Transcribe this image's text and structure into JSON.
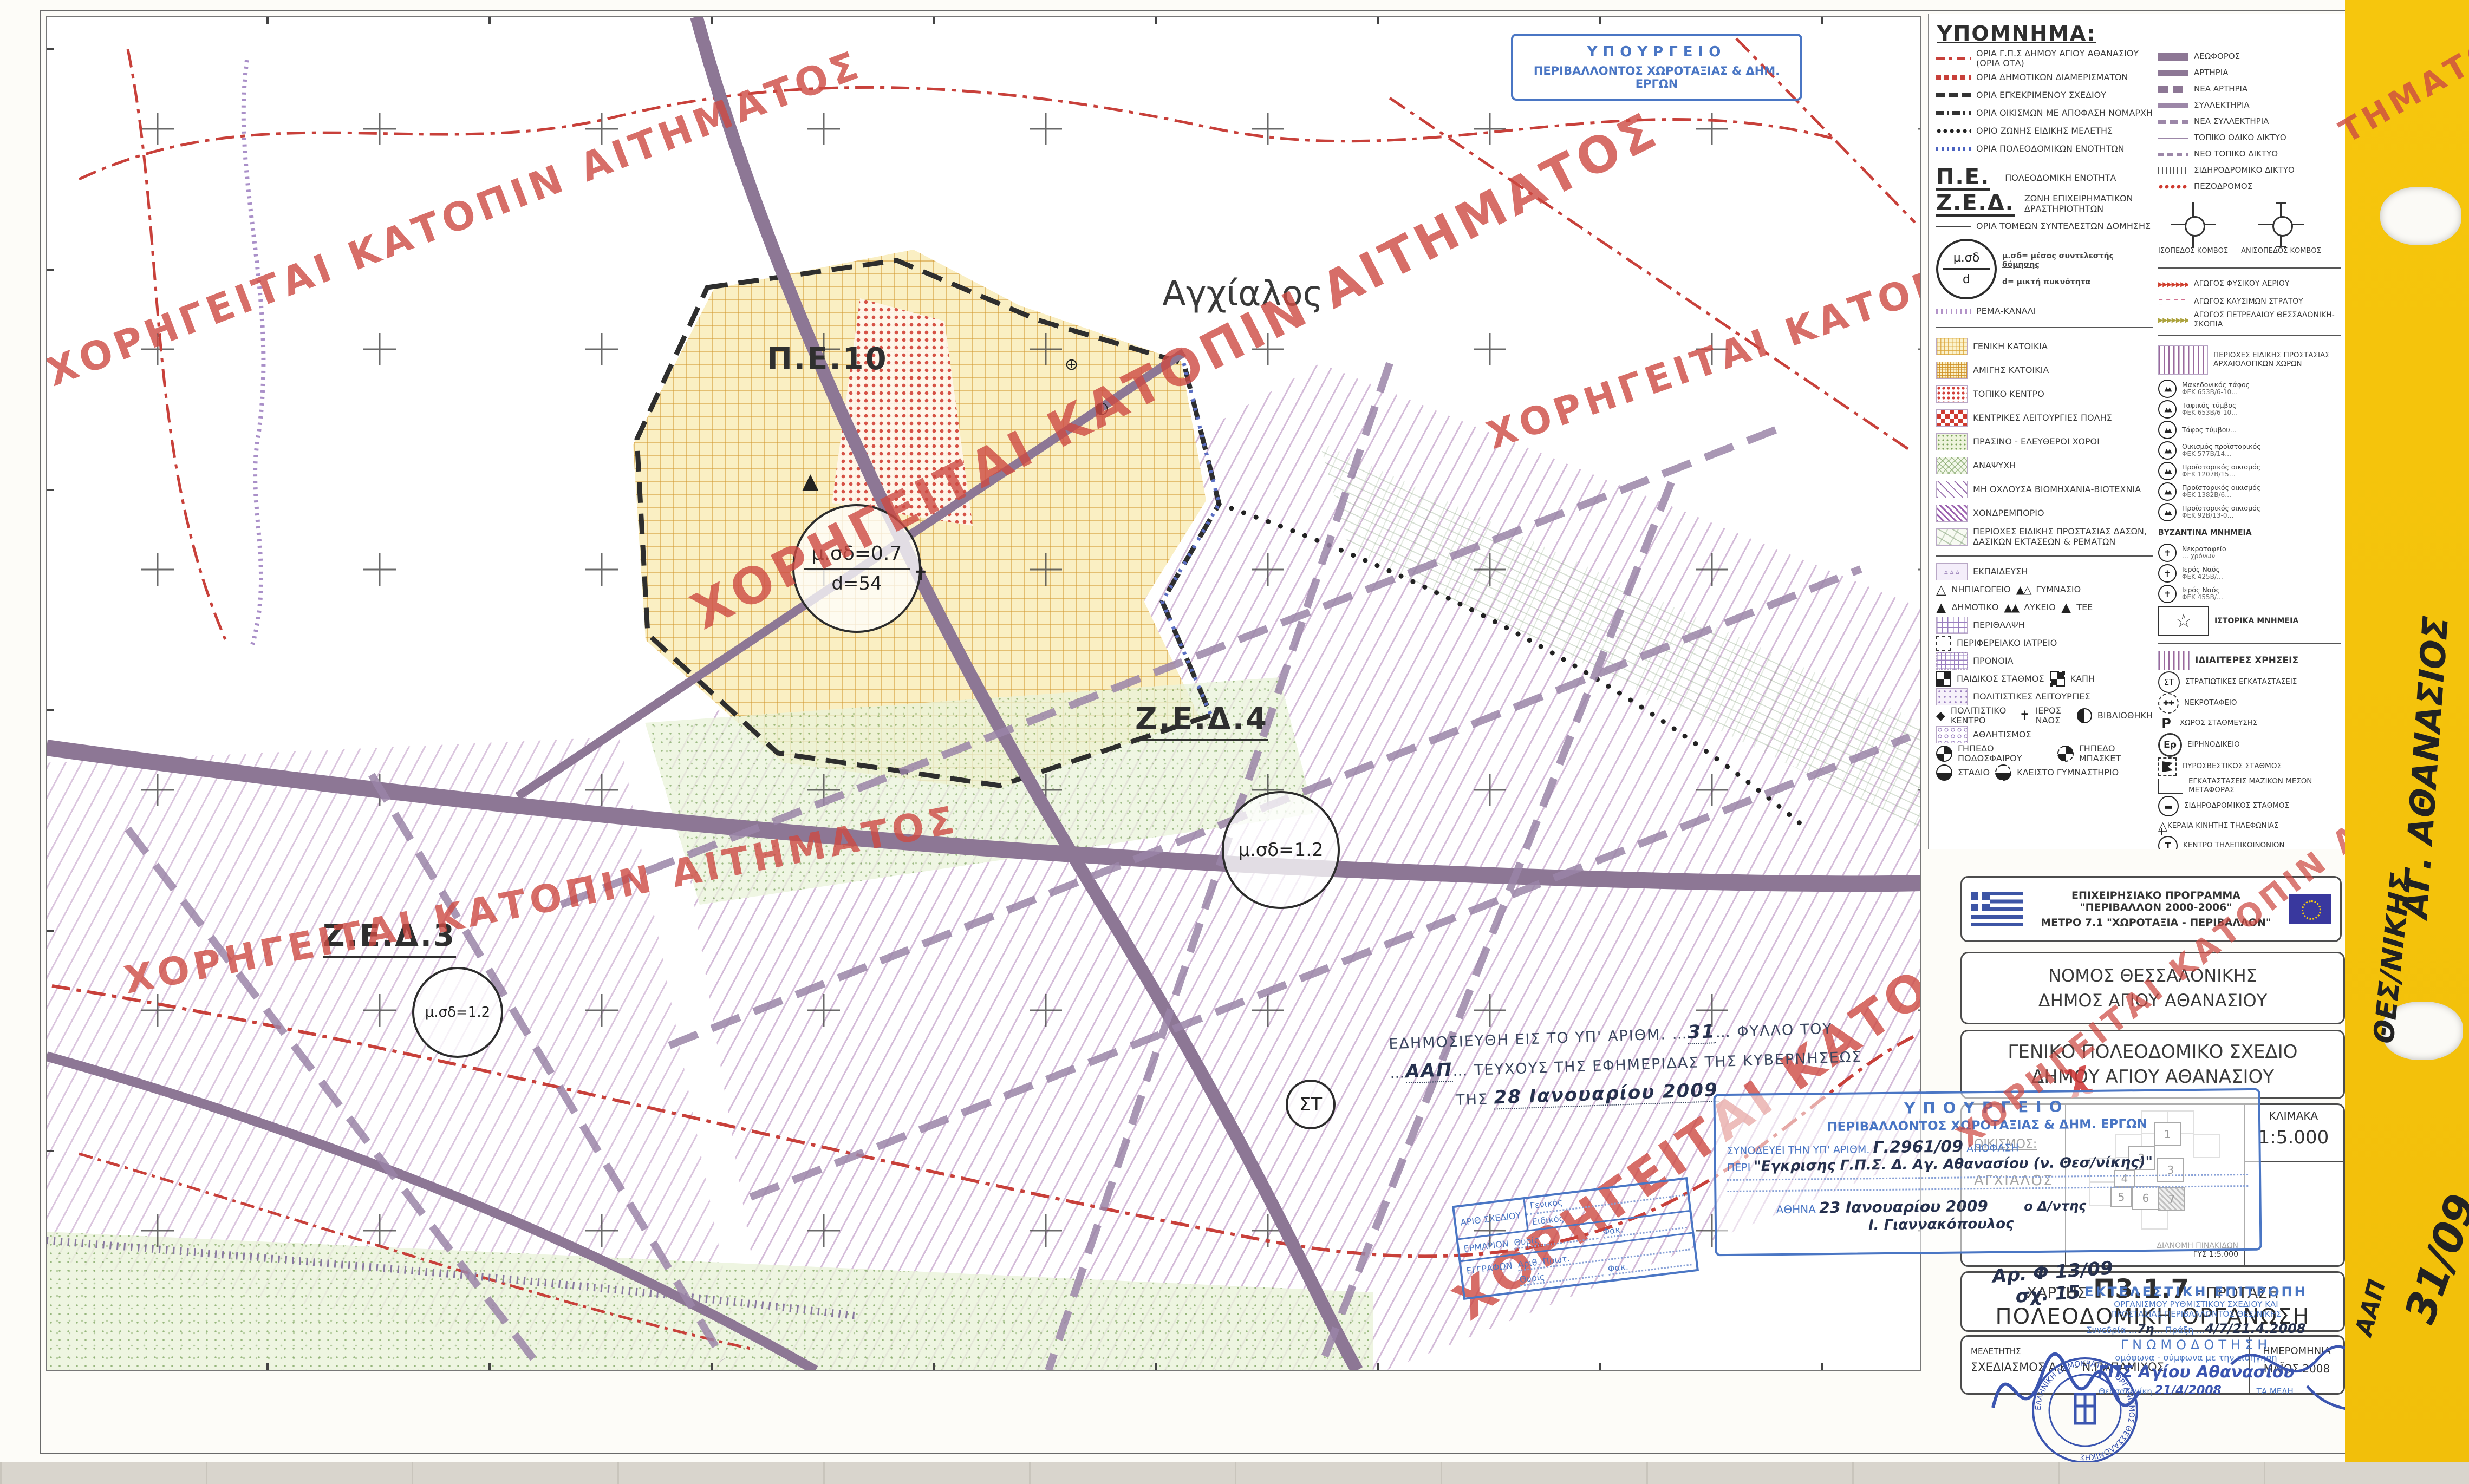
{
  "watermark_text": "ΧΟΡΗΓΕΙΤΑΙ ΚΑΤΟΠΙΝ ΑΙΤΗΜΑΤΟΣ",
  "watermark_frag1": "ΤΗΜΑΤΟΣ",
  "watermark_frag2": "ΙΤΗΜΑΤΟΣ",
  "map": {
    "town_label": "Αγχίαλος",
    "pe_label": "Π.Ε.10",
    "zed4_label": "Ζ.Ε.Δ.4",
    "zed3_label": "Ζ.Ε.Δ.3",
    "st_label": "ΣΤ",
    "circle_pe10_l1": "μ.σδ=0.7",
    "circle_pe10_l2": "d=54",
    "circle_zed4": "μ.σδ=1.2",
    "circle_zed3": "μ.σδ=1.2",
    "left_axis": [
      {
        "v": "4508500"
      },
      {
        "v": "4508000"
      },
      {
        "v": "4507500"
      },
      {
        "v": "4507000"
      },
      {
        "v": "4506500"
      },
      {
        "v": "4506000"
      },
      {
        "v": "4505500"
      }
    ],
    "bottom_axis": [
      {
        "v": "395000"
      },
      {
        "v": "395500"
      },
      {
        "v": "396000"
      },
      {
        "v": "396500"
      },
      {
        "v": "397000"
      },
      {
        "v": "397500"
      },
      {
        "v": "398000"
      },
      {
        "v": "398500"
      },
      {
        "v": "399000"
      }
    ],
    "spot_heights": [
      {
        "v": "8,90"
      },
      {
        "v": "9,00"
      },
      {
        "v": "9,30"
      },
      {
        "v": "10,00"
      },
      {
        "v": "10,20"
      }
    ]
  },
  "side_tab": {
    "line1": "ΑΓ. ΑΘΑΝΑΣΙΟΣ",
    "line2": "ΘΕΣ/ΝΙΚΗΣ",
    "line3": "31/09",
    "line4": "ΑΑΠ"
  },
  "stamps": {
    "ministry_top1": "ΥΠΟΥΡΓΕΙΟ",
    "ministry_top2": "ΠΕΡΙΒΑΛΛΟΝΤΟΣ ΧΩΡΟΤΑΞΙΑΣ & ΔΗΜ. ΕΡΓΩΝ",
    "gazette_pre": "ΕΔΗΜΟΣΙΕΥΘΗ ΕΙΣ ΤΟ ΥΠ' ΑΡΙΘΜ.",
    "gazette_no": "31",
    "gazette_mid": "ΦΥΛΛΟ ΤΟΥ",
    "gazette_issue": "ΑΑΠ",
    "gazette_post": "ΤΕΥΧΟΥΣ ΤΗΣ ΕΦΗΜΕΡΙΔΑΣ ΤΗΣ ΚΥΒΕΡΝΗΣΕΩΣ",
    "gazette_tis": "ΤΗΣ",
    "gazette_date": "28 Ιανουαρίου 2009",
    "decision_h1": "ΥΠΟΥΡΓΕΙΟ",
    "decision_h2": "ΠΕΡΙΒΑΛΛΟΝΤΟΣ ΧΩΡΟΤΑΞΙΑΣ & ΔΗΜ. ΕΡΓΩΝ",
    "decision_pre": "ΣΥΝΟΔΕΥΕΙ ΤΗΝ ΥΠ' ΑΡΙΘΜ.",
    "decision_no": "Γ.2961/09",
    "decision_apofasi": "ΑΠΟΦΑΣΗ",
    "decision_peri": "ΠΕΡΙ",
    "decision_subject": "\"Εγκρισης Γ.Π.Σ. Δ. Αγ. Αθανασίου (ν. Θεσ/νίκης)\"",
    "decision_city": "ΑΘΗΝΑ",
    "decision_date": "23 Ιανουαρίου 2009",
    "decision_role": "ο Δ/ντης",
    "decision_sign": "Ι. Γιαννακόπουλος",
    "file_note1": "Αρ. Φ 13/09",
    "file_note2": "σχ. 15",
    "filing_r1": "ΑΡΙΘ ΣΧΕΔΙΟΥ",
    "filing_r1a": "Γενικός",
    "filing_r1b": "Ειδικός",
    "filing_r2": "ΕΡΜΑΡΙΟΝ",
    "filing_r2a": "Θυρίς",
    "filing_r2b": "Φακ.",
    "filing_r3": "ΕΓΓΡΑΦΩΝ",
    "filing_r3a": "Αριθ. Πρωτ.",
    "filing_r3b": "Θυρίς",
    "filing_r3c": "Φακ.",
    "committee_l1": "ΕΚΤΕΛΕΣΤΙΚΗ ΕΠΙΤΡΟΠΗ",
    "committee_l2": "ΟΡΓΑΝΙΣΜΟΥ ΡΥΘΜΙΣΤΙΚΟΥ ΣΧΕΔΙΟΥ ΚΑΙ",
    "committee_l3": "ΠΡΟΣΤΑΣΙΑΣ ΠΕΡΙΒΑΛΛΟΝΤΟΣ ΘΕΣ/ΝΙΚΗΣ",
    "committee_session_label": "Συνεδρία",
    "committee_session": "7η",
    "committee_praxi_label": "Πράξη",
    "committee_praxi": "4/7/21.4.2008",
    "committee_gnomo": "ΓΝΩΜΟΔΟΤΗΣΗ",
    "committee_l4": "ομόφωνα - σύμφωνα με την εισήγηση",
    "committee_hand": "ΓΠΣ Αγίου Αθανασίου",
    "committee_city": "Θεσσαλονίκη",
    "committee_date": "21/4/2008",
    "committee_members": "ΤΑ ΜΕΛΗ",
    "round_text": "ΕΛΛΗΝΙΚΗ ΔΗΜΟΚΡΑΤΙΑ • ΟΡΓΑΝΙΣΜΟΣ ΘΕΣΣΑΛΟΝΙΚΗΣ"
  },
  "legend": {
    "title": "ΥΠΟΜΝΗΜΑ:",
    "boundaries": [
      {
        "sw": "sw-red-dashdot",
        "label": "ΟΡΙΑ Γ.Π.Σ ΔΗΜΟΥ ΑΓΙΟΥ ΑΘΑΝΑΣΙΟΥ (ΟΡΙΑ ΟΤΑ)"
      },
      {
        "sw": "sw-red-blocks",
        "label": "ΟΡΙΑ ΔΗΜΟΤΙΚΩΝ ΔΙΑΜΕΡΙΣΜΑΤΩΝ"
      },
      {
        "sw": "sw-black-dash",
        "label": "ΟΡΙΑ ΕΓΚΕΚΡΙΜΕΝΟΥ ΣΧΕΔΙΟΥ"
      },
      {
        "sw": "sw-black-dashdot",
        "label": "ΟΡΙΑ ΟΙΚΙΣΜΩΝ ΜΕ ΑΠΟΦΑΣΗ ΝΟΜΑΡΧΗ"
      },
      {
        "sw": "sw-black-dots",
        "label": "ΟΡΙΟ ΖΩΝΗΣ ΕΙΔΙΚΗΣ ΜΕΛΕΤΗΣ"
      },
      {
        "sw": "sw-blue-ticks",
        "label": "ΟΡΙΑ ΠΟΛΕΟΔΟΜΙΚΩΝ ΕΝΟΤΗΤΩΝ"
      }
    ],
    "pe_abbr": "Π.Ε.",
    "pe_label": "ΠΟΛΕΟΔΟΜΙΚΗ ΕΝΟΤΗΤΑ",
    "zed_abbr": "Ζ.Ε.Δ.",
    "zed_label": "ΖΩΝΗ ΕΠΙΧΕΙΡΗΜΑΤΙΚΩΝ ΔΡΑΣΤΗΡΙΟΤΗΤΩΝ",
    "sectors_label": "ΟΡΙΑ ΤΟΜΕΩΝ ΣΥΝΤΕΛΕΣΤΩΝ ΔΟΜΗΣΗΣ",
    "msd_circle_top": "μ.σδ",
    "msd_circle_bottom": "d",
    "msd_note": "μ.σδ= μέσος συντελεστής δόμησης",
    "d_note": "d= μικτή πυκνότητα",
    "rema_label": "ΡΕΜΑ-ΚΑΝΑΛΙ",
    "land_uses": [
      {
        "sw": "sw-genkat",
        "label": "ΓΕΝΙΚΗ ΚΑΤΟΙΚΙΑ"
      },
      {
        "sw": "sw-amigis",
        "label": "ΑΜΙΓΗΣ ΚΑΤΟΙΚΙΑ"
      },
      {
        "sw": "sw-topiko",
        "label": "ΤΟΠΙΚΟ ΚΕΝΤΡΟ"
      },
      {
        "sw": "sw-kentrikes",
        "label": "ΚΕΝΤΡΙΚΕΣ ΛΕΙΤΟΥΡΓΙΕΣ ΠΟΛΗΣ"
      },
      {
        "sw": "sw-prasino",
        "label": "ΠΡΑΣΙΝΟ - ΕΛΕΥΘΕΡΟΙ ΧΩΡΟΙ"
      },
      {
        "sw": "sw-anapsixi",
        "label": "ΑΝΑΨΥΧΗ"
      },
      {
        "sw": "sw-biom",
        "label": "ΜΗ ΟΧΛΟΥΣΑ ΒΙΟΜΗΧΑΝΙΑ-ΒΙΟΤΕΧΝΙΑ"
      },
      {
        "sw": "sw-xondremp",
        "label": "ΧΟΝΔΡΕΜΠΟΡΙΟ"
      },
      {
        "sw": "sw-dasos",
        "label": "ΠΕΡΙΟΧΕΣ ΕΙΔΙΚΗΣ ΠΡΟΣΤΑΣΙΑΣ ΔΑΣΩΝ, ΔΑΣΙΚΩΝ ΕΚΤΑΣΕΩΝ & ΡΕΜΑΤΩΝ"
      }
    ],
    "facilities": [
      {
        "sw": "sw-ekpaideusi",
        "label": "ΕΚΠΑΙΔΕΥΣΗ"
      },
      {
        "ic": "ic-tri-open",
        "label": "ΝΗΠΙΑΓΩΓΕΙΟ",
        "ic2": "ic-tri-pair",
        "label2": "ΓΥΜΝΑΣΙΟ"
      },
      {
        "ic": "ic-tri-fill",
        "label": "ΔΗΜΟΤΙΚΟ",
        "ic2": "ic-tri-pair2",
        "label2": "ΛΥΚΕΙΟ",
        "ic3": "ic-tri-fill",
        "label3": "ΤΕΕ"
      },
      {
        "sw": "sw-perithalpsi",
        "label": "ΠΕΡΙΘΑΛΨΗ"
      },
      {
        "ic": "ic-sq-dash",
        "label": "ΠΕΡΙΦΕΡΕΙΑΚΟ ΙΑΤΡΕΙΟ"
      },
      {
        "sw": "sw-pronoia",
        "label": "ΠΡΟΝΟΙΑ"
      },
      {
        "ic": "ic-checker",
        "label": "ΠΑΙΔΙΚΟΣ ΣΤΑΘΜΟΣ",
        "ic2": "ic-checker2",
        "label2": "ΚΑΠΗ"
      },
      {
        "sw": "sw-politistiko",
        "label": "ΠΟΛΙΤΙΣΤΙΚΕΣ ΛΕΙΤΟΥΡΓΙΕΣ"
      },
      {
        "ic": "ic-culture",
        "label": "ΠΟΛΙΤΙΣΤΙΚΟ ΚΕΝΤΡΟ",
        "ic2": "ic-church",
        "label2": "ΙΕΡΟΣ ΝΑΟΣ",
        "ic3": "ic-library",
        "label3": "ΒΙΒΛΙΟΘΗΚΗ"
      },
      {
        "sw": "sw-athlitismos",
        "label": "ΑΘΛΗΤΙΣΜΟΣ"
      },
      {
        "ic": "ic-quarter",
        "label": "ΓΗΠΕΔΟ ΠΟΔΟΣΦΑΙΡΟΥ",
        "ic2": "ic-quarter2",
        "label2": "ΓΗΠΕΔΟ ΜΠΑΣΚΕΤ"
      },
      {
        "ic": "ic-half",
        "label": "ΣΤΑΔΙΟ",
        "ic2": "ic-half2",
        "label2": "ΚΛΕΙΣΤΟ ΓΥΜΝΑΣΤΗΡΙΟ"
      }
    ],
    "roads": [
      {
        "sw": "sw-leoforos",
        "label": "ΛΕΩΦΟΡΟΣ"
      },
      {
        "sw": "sw-artiria",
        "label": "ΑΡΤΗΡΙΑ"
      },
      {
        "sw": "sw-nea-artiria",
        "label": "ΝΕΑ ΑΡΤΗΡΙΑ"
      },
      {
        "sw": "sw-syllektiria",
        "label": "ΣΥΛΛΕΚΤΗΡΙΑ"
      },
      {
        "sw": "sw-nea-syllektiria",
        "label": "ΝΕΑ ΣΥΛΛΕΚΤΗΡΙΑ"
      },
      {
        "sw": "sw-topiko-odiko",
        "label": "ΤΟΠΙΚΟ ΟΔΙΚΟ ΔΙΚΤΥΟ"
      },
      {
        "sw": "sw-neo-topiko",
        "label": "ΝΕΟ ΤΟΠΙΚΟ ΔΙΚΤΥΟ"
      },
      {
        "sw": "sw-rail",
        "label": "ΣΙΔΗΡΟΔΡΟΜΙΚΟ ΔΙΚΤΥΟ"
      },
      {
        "sw": "sw-pezodromos",
        "label": "ΠΕΖΟΔΡΟΜΟΣ"
      }
    ],
    "junction_iso": "ΙΣΟΠΕΔΟΣ ΚΟΜΒΟΣ",
    "junction_aniso": "ΑΝΙΣΟΠΕΔΟΣ ΚΟΜΒΟΣ",
    "pipelines": [
      {
        "sw": "sw-gas",
        "label": "ΑΓΩΓΟΣ ΦΥΣΙΚΟΥ ΑΕΡΙΟΥ"
      },
      {
        "sw": "sw-fuel",
        "label": "ΑΓΩΓΟΣ ΚΑΥΣΙΜΩΝ ΣΤΡΑΤΟΥ"
      },
      {
        "sw": "sw-oil",
        "label": "ΑΓΩΓΟΣ ΠΕΤΡΕΛΑΙΟΥ ΘΕΣΣΑΛΟΝΙΚΗ-ΣΚΟΠΙΑ"
      }
    ],
    "arch_label": "ΠΕΡΙΟΧΕΣ ΕΙΔΙΚΗΣ ΠΡΟΣΤΑΣΙΑΣ ΑΡΧΑΙΟΛΟΓΙΚΩΝ ΧΩΡΩΝ",
    "monuments": [
      {
        "ic": "ic-tumulus",
        "l1": "Μακεδονικός τάφος",
        "l2": "ΦΕΚ 653Β/6-10…"
      },
      {
        "ic": "ic-tumulus",
        "l1": "Ταφικός τύμβος",
        "l2": "ΦΕΚ 653Β/6-10…"
      },
      {
        "ic": "ic-tumulus",
        "l1": "Τάφος τύμβου…"
      },
      {
        "ic": "ic-tumulus",
        "l1": "Οικισμός προϊστορικός",
        "l2": "ΦΕΚ 577Β/14…"
      },
      {
        "ic": "ic-tumulus",
        "l1": "Προϊστορικός οικισμός",
        "l2": "ΦΕΚ 1207Β/15…"
      },
      {
        "ic": "ic-tumulus",
        "l1": "Προϊστορικός οικισμός",
        "l2": "ΦΕΚ 1382Β/6…"
      },
      {
        "ic": "ic-tumulus",
        "l1": "Προϊστορικός οικισμός",
        "l2": "ΦΕΚ 92Β/13-0…"
      }
    ],
    "byzantine_title": "ΒΥΖΑΝΤΙΝΑ ΜΝΗΜΕΙΑ",
    "byzantine": [
      {
        "ic": "ic-church-circ",
        "l1": "Νεκροταφείο",
        "l2": "… χρόνων"
      },
      {
        "ic": "ic-church-circ",
        "l1": "Ιερός Ναός",
        "l2": "ΦΕΚ 425Β/…"
      },
      {
        "ic": "ic-church-circ",
        "l1": "Ιερός Ναός",
        "l2": "ΦΕΚ 455Β/…"
      }
    ],
    "historic_label": "ΙΣΤΟΡΙΚΑ ΜΝΗΜΕΙΑ",
    "special_title": "ΙΔΙΑΙΤΕΡΕΣ ΧΡΗΣΕΙΣ",
    "special": [
      {
        "ic": "ic-st",
        "label": "ΣΤΡΑΤΙΩΤΙΚΕΣ ΕΓΚΑΤΑΣΤΑΣΕΙΣ"
      },
      {
        "ic": "ic-nekro",
        "label": "ΝΕΚΡΟΤΑΦΕΙΟ"
      },
      {
        "ic": "ic-p",
        "label": "ΧΩΡΟΣ ΣΤΑΘΜΕΥΣΗΣ"
      },
      {
        "ic": "ic-er",
        "label": "ΕΙΡΗΝΟΔΙΚΕΙΟ"
      },
      {
        "ic": "ic-fire",
        "label": "ΠΥΡΟΣΒΕΣΤΙΚΟΣ ΣΤΑΘΜΟΣ"
      },
      {
        "ic": "ic-mass",
        "label": "ΕΓΚΑΤΑΣΤΑΣΕΙΣ ΜΑΖΙΚΩΝ ΜΕΣΩΝ ΜΕΤΑΦΟΡΑΣ"
      },
      {
        "ic": "ic-railst",
        "label": "ΣΙΔΗΡΟΔΡΟΜΙΚΟΣ ΣΤΑΘΜΟΣ"
      },
      {
        "ic": "ic-antenna",
        "label": "ΚΕΡΑΙΑ ΚΙΝΗΤΗΣ ΤΗΛΕΦΩΝΙΑΣ"
      },
      {
        "ic": "ic-telecom",
        "label": "ΚΕΝΤΡΟ ΤΗΛΕΠΙΚΟΙΝΩΝΙΩΝ"
      },
      {
        "ic": "ic-tb",
        "label": "ΚΕΝΤΡΟ ΓΕΝΕΤΙΚΗΣ ΒΕΛΤΙΩΣΗΣ"
      }
    ]
  },
  "titleblock": {
    "eu_line1": "ΕΠΙΧΕΙΡΗΣΙΑΚΟ ΠΡΟΓΡΑΜΜΑ \"ΠΕΡΙΒΑΛΛΟΝ 2000-2006\"",
    "eu_line2": "ΜΕΤΡΟ 7.1 \"ΧΩΡΟΤΑΞΙΑ - ΠΕΡΙΒΑΛΛΟΝ\"",
    "nomos": "ΝΟΜΟΣ ΘΕΣΣΑΛΟΝΙΚΗΣ",
    "dimos": "ΔΗΜΟΣ ΑΓΙΟΥ ΑΘΑΝΑΣΙΟΥ",
    "gps1": "ΓΕΝΙΚΟ ΠΟΛΕΟΔΟΜΙΚΟ ΣΧΕΔΙΟ",
    "gps2": "ΔΗΜΟΥ ΑΓΙΟΥ ΑΘΑΝΑΣΙΟΥ",
    "oikismos_label": "ΟΙΚΙΣΜΟΣ:",
    "oikismos": "ΑΓΧΙΑΛΟΣ",
    "klimaka_label": "ΚΛΙΜΑΚΑ",
    "klimaka": "1:5.000",
    "sheet_note1": "ΔΙΑΝΟΜΗ ΠΙΝΑΚΙΔΩΝ",
    "sheet_note2": "ΓΥΣ 1:5.000",
    "sheets": [
      {
        "n": "1"
      },
      {
        "n": "2"
      },
      {
        "n": "3"
      },
      {
        "n": "4"
      },
      {
        "n": "5"
      },
      {
        "n": "6"
      },
      {
        "n": "7"
      }
    ],
    "proj": [
      {
        "v": "Ε.Γ.Σ.Α. 1987"
      },
      {
        "v": "Ελλειψοειδές GRS 80"
      },
      {
        "v": "a = 6378137  f = 1/298.2572236"
      },
      {
        "v": "Εγκάρσια Μερκατορική Προβολή"
      },
      {
        "v": "Μέτρο γραμμικής παραμόρφωσης Κ = 0.999744197"
      },
      {
        "v": "Κεντρικός Μεσημβρινός λ = 24 με Κο = 0.9996"
      },
      {
        "v": "Στον Κεντρικό Μεσημβρινό αναφοράς Χ = 500.000 m"
      },
      {
        "v": "Γεωγραφικό Πλάτος αναφοράς 00 00' 00\""
      }
    ],
    "xartis_label": "ΧΑΡΤΗΣ",
    "xartis_code": "Π3.1.7",
    "xartis_suffix": "- ΠΡΟΤΑΣΗ",
    "xartis_title": "ΠΟΛΕΟΔΟΜΙΚΗ ΟΡΓΑΝΩΣΗ",
    "meletitis_label": "ΜΕΛΕΤΗΤΗΣ",
    "meletitis": "ΣΧΕΔΙΑΣΜΟΣ Α.Ε. - Ν.ΠΑΠΑΜΙΧΟΣ",
    "date_label": "ΗΜΕΡΟΜΗΝΙΑ",
    "date": "ΜΑΪΟΣ 2008"
  }
}
